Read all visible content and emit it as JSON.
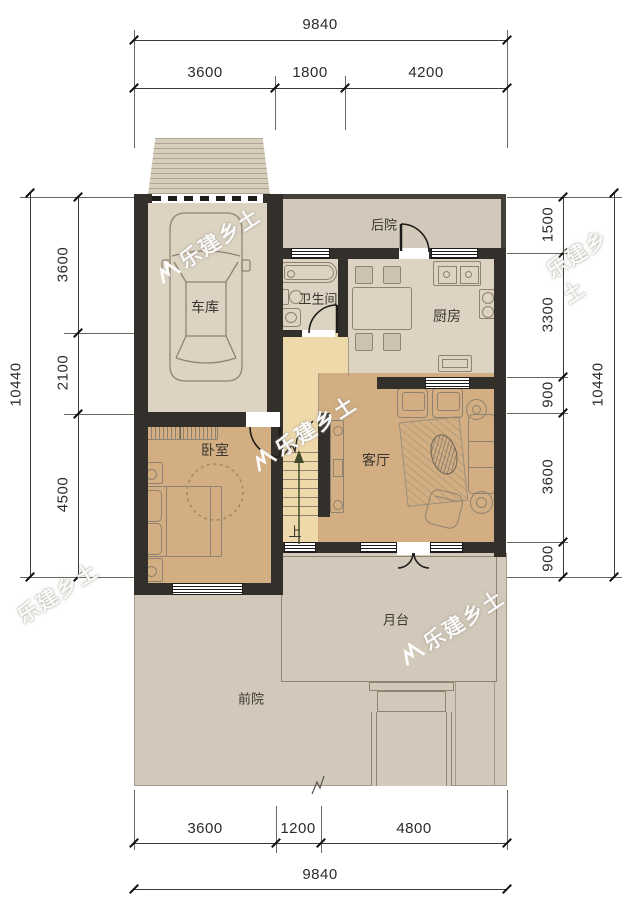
{
  "rooms": {
    "garage": "车库",
    "backyard": "后院",
    "bathroom": "卫生间",
    "kitchen": "厨房",
    "bedroom": "卧室",
    "living_room": "客厅",
    "platform": "月台",
    "front_yard": "前院"
  },
  "stairs": {
    "up_label": "上"
  },
  "watermark": {
    "text": "乐建乡土"
  },
  "dims": {
    "top": {
      "overall": "9840",
      "segments": [
        "3600",
        "1800",
        "4200"
      ]
    },
    "bottom": {
      "overall": "9840",
      "segments": [
        "3600",
        "1200",
        "4800"
      ]
    },
    "left": {
      "overall": "10440",
      "segments": [
        "3600",
        "2100",
        "4500"
      ]
    },
    "right": {
      "overall": "10440",
      "segments": [
        "1500",
        "3300",
        "900",
        "3600",
        "900"
      ]
    }
  },
  "colors": {
    "wall": "#332f2b",
    "yard": "#d2c9ba",
    "room_floor": "#dcd3c2",
    "warm_floor": "#d2ae82",
    "hall_floor": "#eed9ab"
  }
}
